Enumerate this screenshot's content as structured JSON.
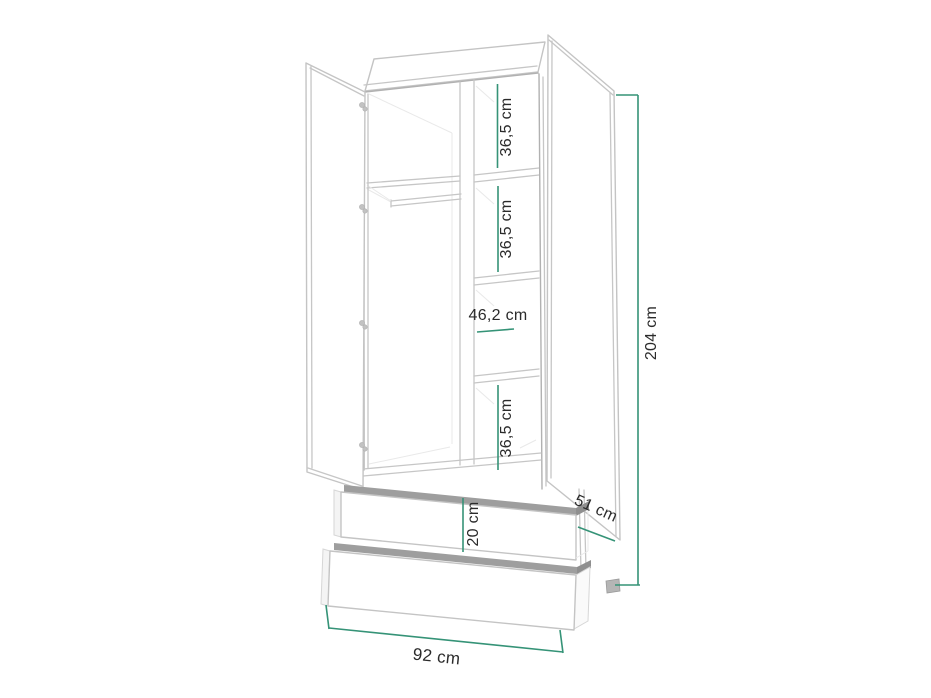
{
  "diagram": {
    "name": "wardrobe-dimensions-diagram",
    "description": "Line drawing of a two-door wardrobe with open doors, shelf column, clothes rail and two drawers, annotated with dimensions",
    "background_color": "#ffffff",
    "dimension_line_color": "#359377",
    "label_color": "#2b2b2b",
    "outline_color": "#c6c6c6",
    "annotations": {
      "compartment_1_height": "36,5 cm",
      "compartment_2_height": "36,5 cm",
      "compartment_3_width": "46,2 cm",
      "compartment_4_height": "36,5 cm",
      "drawer_height": "20 cm",
      "total_height": "204 cm",
      "depth": "51 cm",
      "total_width": "92 cm"
    },
    "measurements_cm": {
      "compartment_1_height": 36.5,
      "compartment_2_height": 36.5,
      "compartment_3_width": 46.2,
      "compartment_4_height": 36.5,
      "drawer_height": 20,
      "total_height": 204,
      "depth": 51,
      "total_width": 92
    }
  }
}
